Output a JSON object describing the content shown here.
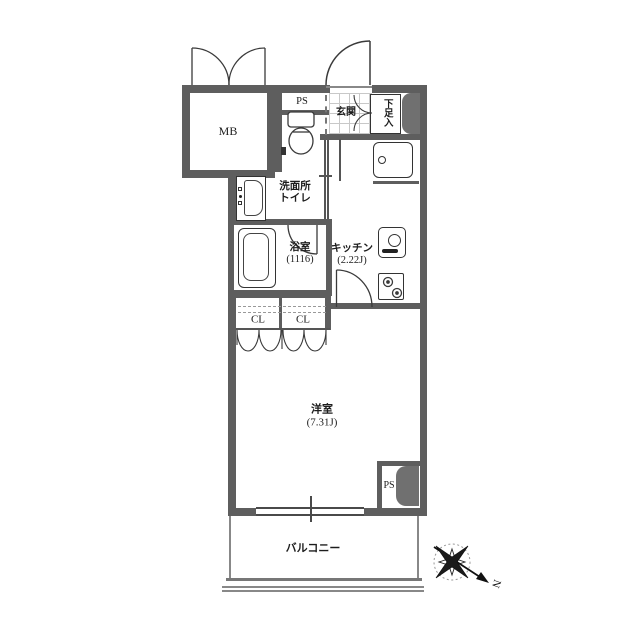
{
  "labels": {
    "mb": "MB",
    "ps_top": "PS",
    "genkan": "玄関",
    "shoe_box": "下足入",
    "washroom": "洗面所",
    "toilet": "トイレ",
    "bath": "浴室",
    "bath_size": "(1116)",
    "kitchen": "キッチン",
    "kitchen_size": "(2.22J)",
    "closet_left": "CL",
    "closet_right": "CL",
    "western_room": "洋室",
    "western_room_size": "(7.31J)",
    "ps_bottom": "PS",
    "balcony": "バルコニー",
    "compass_north": "N"
  },
  "colors": {
    "wall": "#5e5e5e",
    "line": "#3b3b3b",
    "duct": "#707070",
    "tile": "#c8c8c8",
    "bg": "#ffffff"
  }
}
